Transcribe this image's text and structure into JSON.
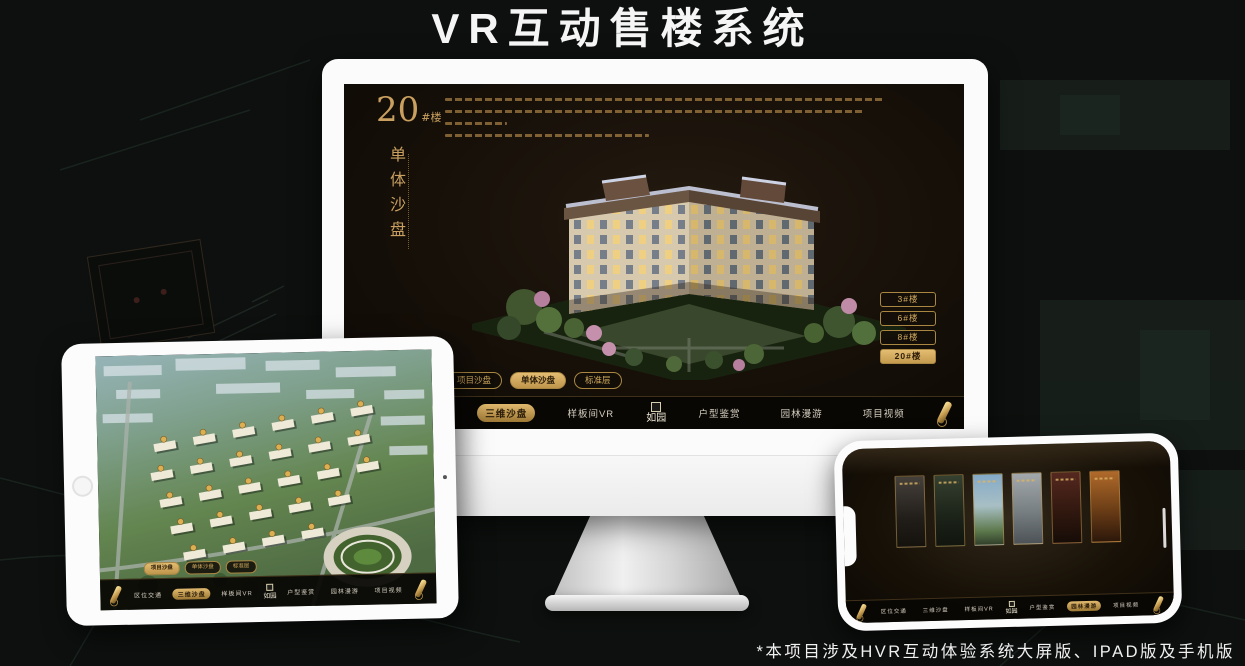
{
  "page": {
    "title": "VR互动售楼系统",
    "footnote": "*本项目涉及HVR互动体验系统大屏版、IPAD版及手机版"
  },
  "colors": {
    "gold": "#c9a05f",
    "gold_bright": "#e3bd72",
    "selected_text": "#2b1d0a",
    "screen_bg": "#17110a"
  },
  "nav": {
    "logo": "如园",
    "items": [
      "区位交通",
      "三维沙盘",
      "样板间VR",
      "户型鉴赏",
      "园林漫游",
      "项目视频"
    ]
  },
  "monitor": {
    "building_no": "20",
    "building_no_suffix": "#楼",
    "subtitle_vertical": "单体沙盘",
    "floor_buttons": [
      "3#楼",
      "6#楼",
      "8#楼",
      "20#楼"
    ],
    "selected_floor": "20#楼",
    "tabs": [
      "项目沙盘",
      "单体沙盘",
      "标准层"
    ],
    "selected_tab": "单体沙盘",
    "highlighted_nav_item": "三维沙盘"
  },
  "tablet": {
    "tabs": [
      "项目沙盘",
      "单体沙盘",
      "标准层"
    ],
    "selected_tab": "项目沙盘",
    "highlighted_nav_item": "三维沙盘"
  },
  "phone": {
    "highlighted_nav_item": "园林漫游"
  }
}
